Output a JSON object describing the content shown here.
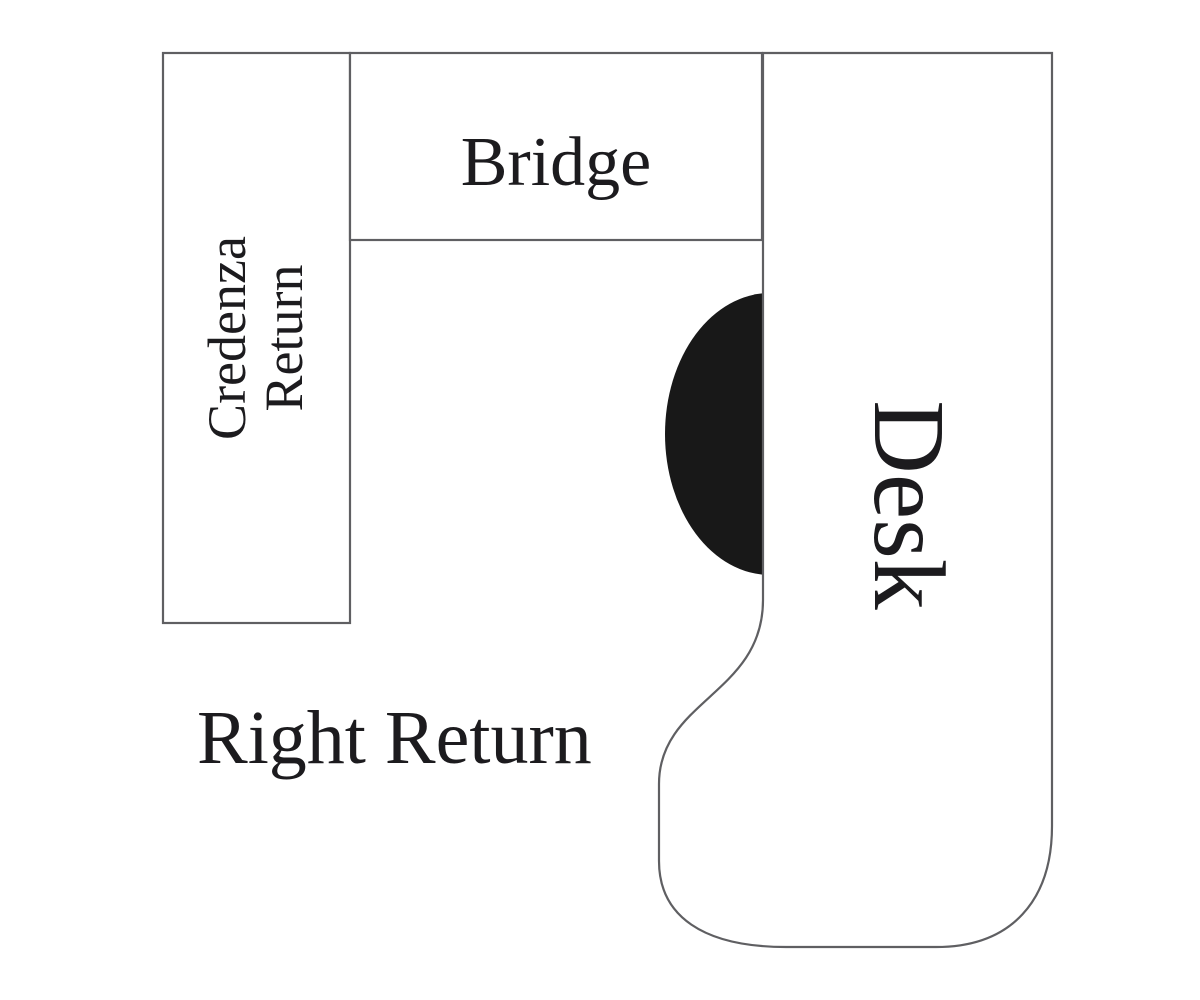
{
  "diagram": {
    "type": "office-desk-configuration-floorplan",
    "labels": {
      "credenza_return": "Credenza\nReturn",
      "bridge": "Bridge",
      "desk": "Desk",
      "right_return": "Right Return"
    },
    "colors": {
      "background": "#ffffff",
      "ink": "#1c1b1e",
      "outline": "#5f5f62",
      "chair_fill": "#181818"
    }
  }
}
